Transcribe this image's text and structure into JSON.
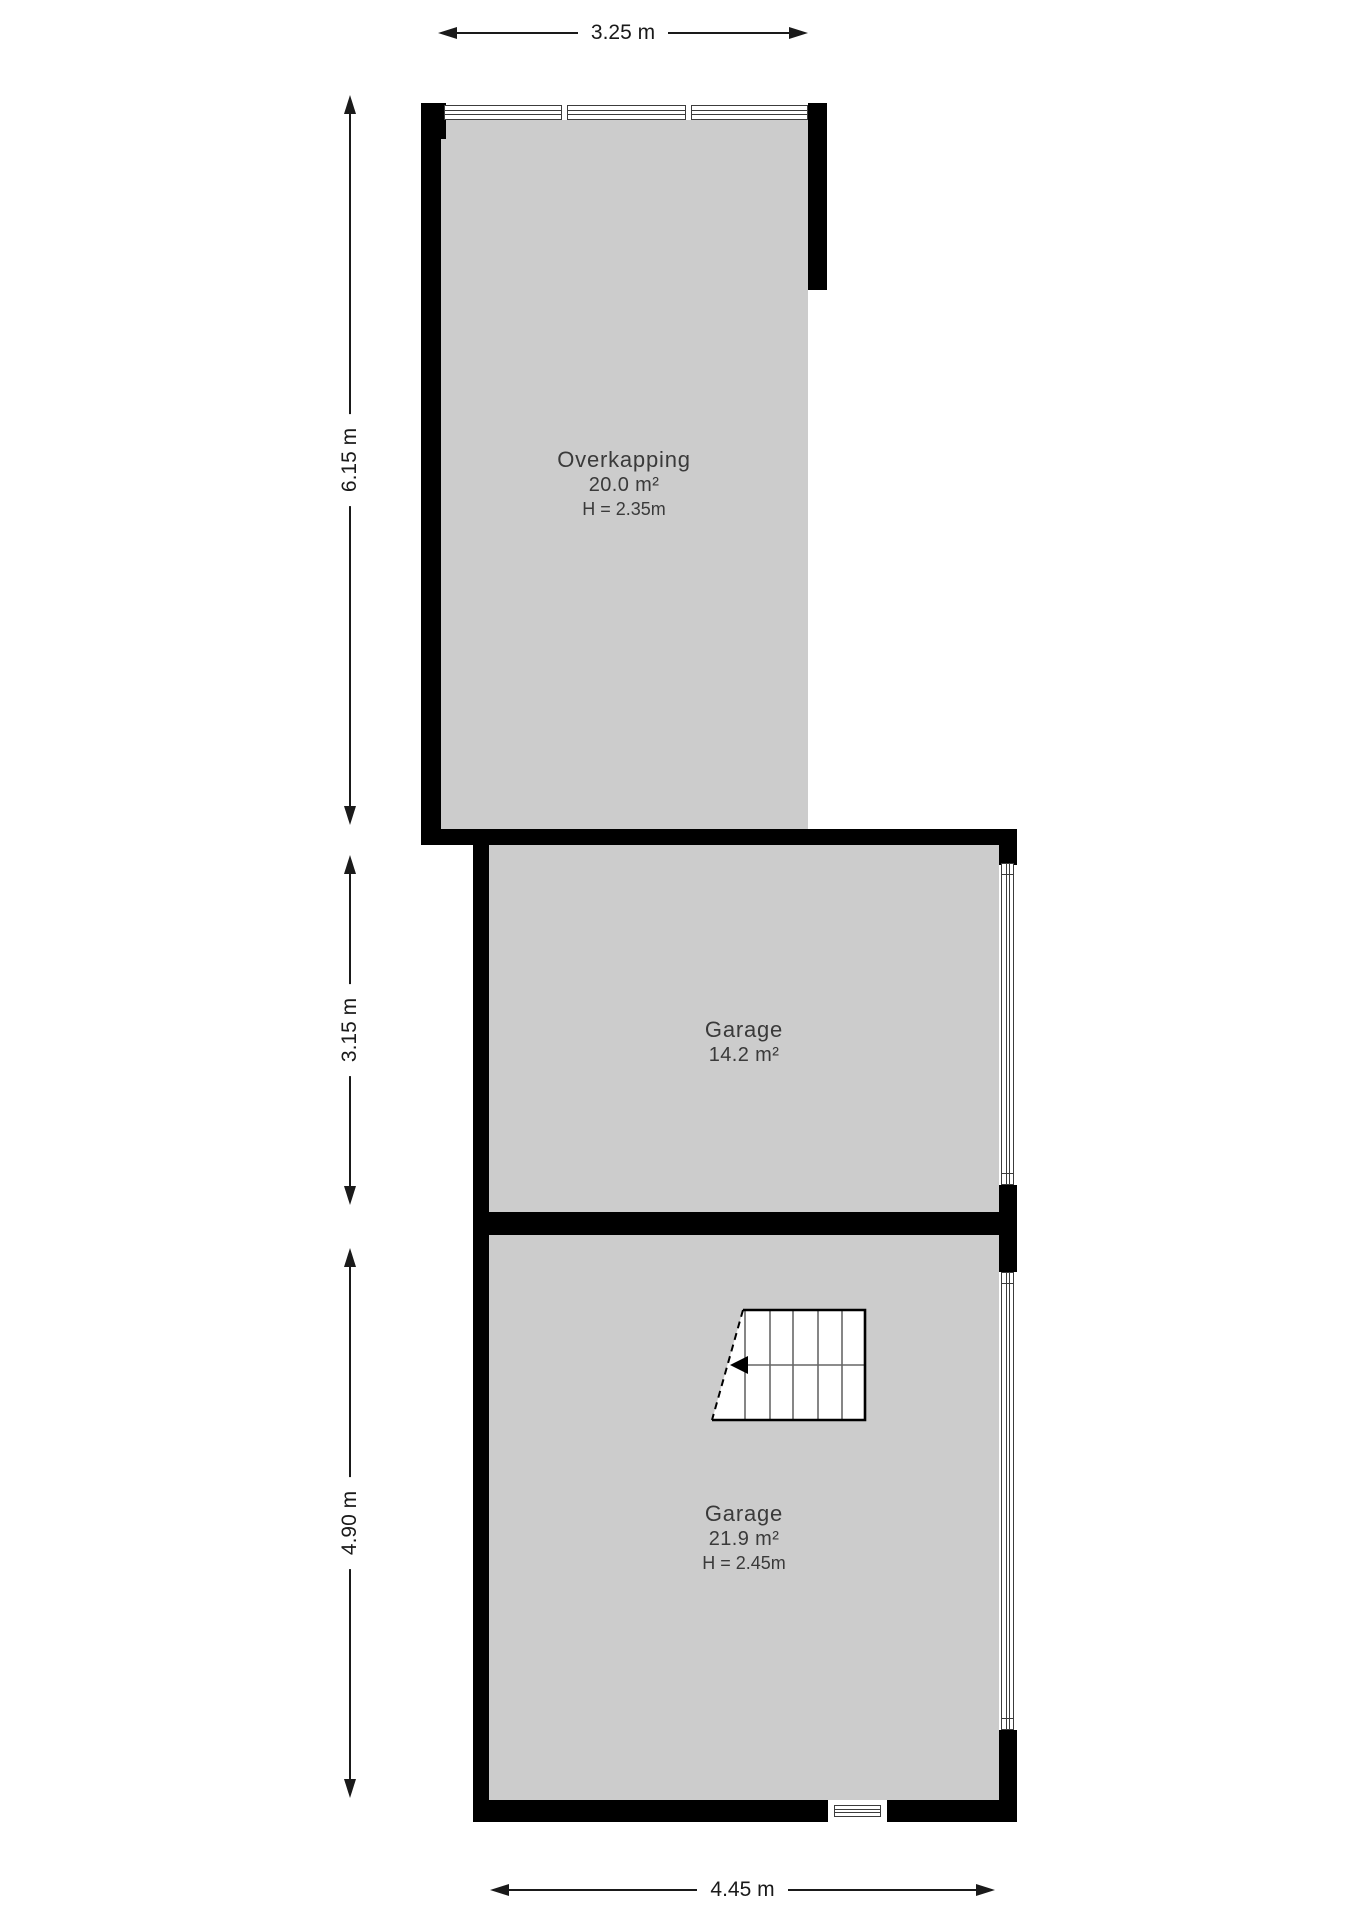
{
  "plan": {
    "type": "floor-plan"
  },
  "colors": {
    "wall": "#000000",
    "room_fill": "#cccccc",
    "text": "#3a3a3a",
    "dim_line": "#1a1a1a",
    "background": "#ffffff"
  },
  "rooms": [
    {
      "name": "Overkapping",
      "area": "20.0 m²",
      "height": "H = 2.35m"
    },
    {
      "name": "Garage",
      "area": "14.2 m²"
    },
    {
      "name": "Garage",
      "area": "21.9 m²",
      "height": "H = 2.45m"
    }
  ],
  "dimensions": {
    "top": {
      "label": "3.25 m"
    },
    "left_upper": {
      "label": "6.15 m"
    },
    "left_middle": {
      "label": "3.15 m"
    },
    "left_lower": {
      "label": "4.90 m"
    },
    "bottom": {
      "label": "4.45 m"
    }
  },
  "stairs": {
    "direction": "left"
  }
}
